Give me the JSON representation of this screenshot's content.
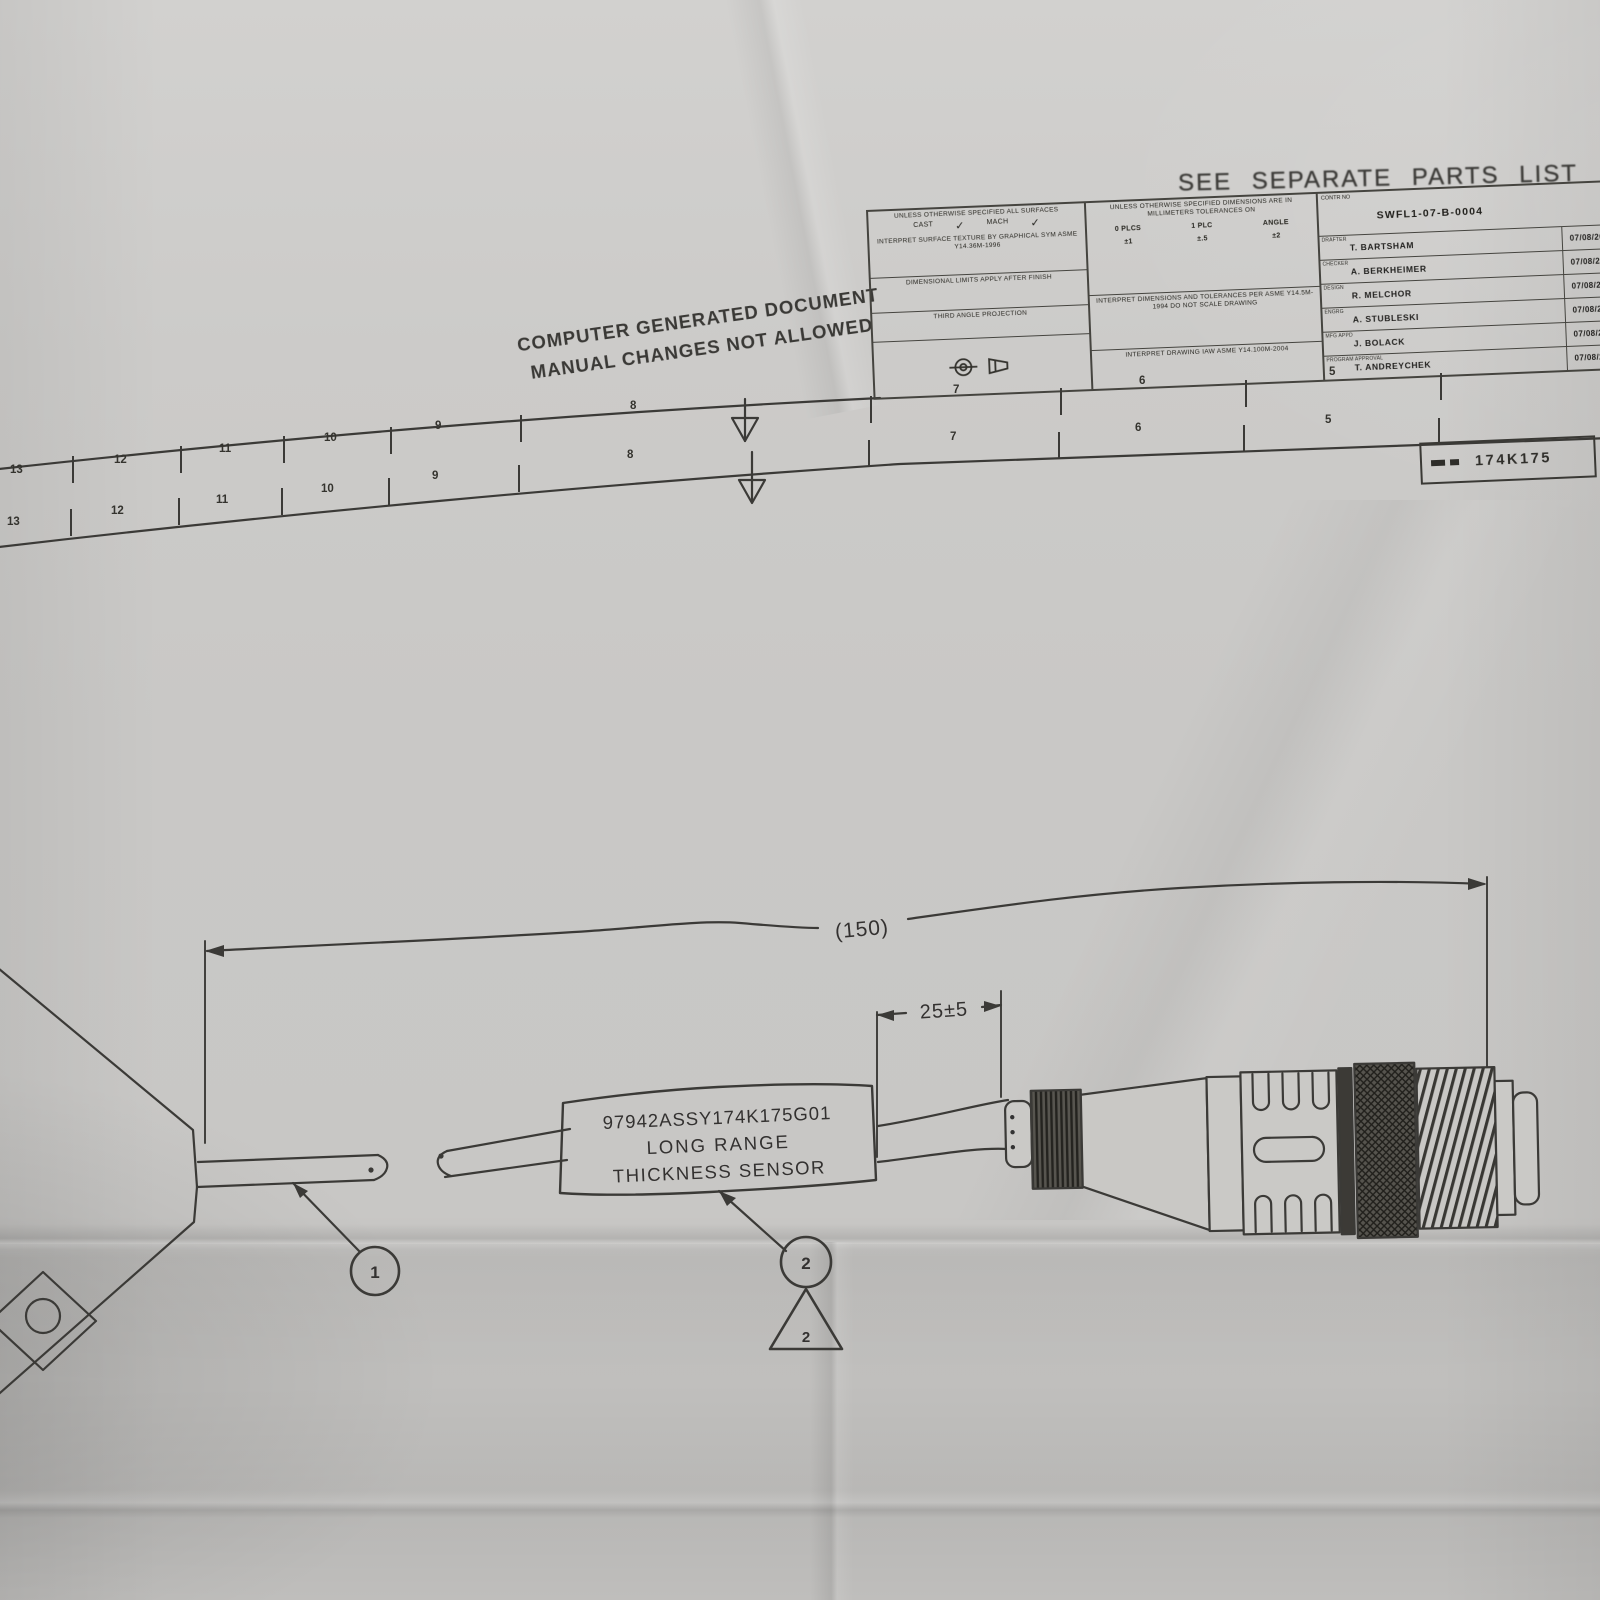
{
  "header": {
    "parts_note": "SEE  SEPARATE  PARTS  LIST"
  },
  "doc_note": {
    "line1": "COMPUTER GENERATED DOCUMENT",
    "line2": "MANUAL CHANGES NOT ALLOWED"
  },
  "title_block": {
    "surface_note": "UNLESS OTHERWISE SPECIFIED ALL SURFACES",
    "cast_label": "CAST",
    "mach_label": "MACH",
    "check_glyph": "✓",
    "texture_note": "INTERPRET SURFACE TEXTURE BY GRAPHICAL SYM ASME Y14.36M-1996",
    "limits_note": "DIMENSIONAL LIMITS APPLY AFTER FINISH",
    "projection_note": "THIRD ANGLE PROJECTION",
    "tolerance_header": "UNLESS OTHERWISE SPECIFIED DIMENSIONS ARE IN MILLIMETERS TOLERANCES ON",
    "tolerance_cols": [
      "0 PLCS",
      "1 PLC",
      "ANGLE"
    ],
    "tolerance_vals": [
      "±1",
      "±.5",
      "±2"
    ],
    "dims_note": "INTERPRET DIMENSIONS AND TOLERANCES PER ASME Y14.5M-1994 DO NOT SCALE DRAWING",
    "drawing_note": "INTERPRET DRAWING IAW ASME Y14.100M-2004",
    "contract_label": "CONTR NO",
    "contract_no": "SWFL1-07-B-0004",
    "approvals": [
      {
        "role": "DRAFTER",
        "name": "T. BARTSHAM",
        "date": "07/08/20"
      },
      {
        "role": "CHECKER",
        "name": "A. BERKHEIMER",
        "date": "07/08/20"
      },
      {
        "role": "DESIGN",
        "name": "R. MELCHOR",
        "date": "07/08/20"
      },
      {
        "role": "ENGRG",
        "name": "A. STUBLESKI",
        "date": "07/08/20"
      },
      {
        "role": "MFG APPD",
        "name": "J. BOLACK",
        "date": "07/08/20"
      },
      {
        "role": "PROGRAM APPROVAL",
        "name": "T. ANDREYCHEK",
        "date": "07/08/20"
      }
    ],
    "size_code": "A1",
    "partial_letter": "L"
  },
  "border": {
    "drawing_number": "174K175",
    "zones_upper": [
      {
        "label": "13",
        "x": 16,
        "y": 471
      },
      {
        "label": "12",
        "x": 120,
        "y": 461
      },
      {
        "label": "11",
        "x": 225,
        "y": 450
      },
      {
        "label": "10",
        "x": 330,
        "y": 439
      },
      {
        "label": "9",
        "x": 441,
        "y": 427
      },
      {
        "label": "8",
        "x": 636,
        "y": 407
      },
      {
        "label": "7",
        "x": 959,
        "y": 391
      },
      {
        "label": "6",
        "x": 1145,
        "y": 382
      },
      {
        "label": "5",
        "x": 1335,
        "y": 373
      }
    ],
    "ticks_upper": [
      {
        "x": 72,
        "y": 456
      },
      {
        "x": 180,
        "y": 446
      },
      {
        "x": 283,
        "y": 436
      },
      {
        "x": 390,
        "y": 427
      },
      {
        "x": 520,
        "y": 415
      },
      {
        "x": 870,
        "y": 396
      },
      {
        "x": 1060,
        "y": 388
      },
      {
        "x": 1245,
        "y": 380
      },
      {
        "x": 1440,
        "y": 373
      }
    ],
    "zones_lower": [
      {
        "label": "13",
        "x": 13,
        "y": 523
      },
      {
        "label": "12",
        "x": 117,
        "y": 512
      },
      {
        "label": "11",
        "x": 222,
        "y": 501
      },
      {
        "label": "10",
        "x": 327,
        "y": 490
      },
      {
        "label": "9",
        "x": 438,
        "y": 477
      },
      {
        "label": "8",
        "x": 633,
        "y": 456
      },
      {
        "label": "7",
        "x": 956,
        "y": 438
      },
      {
        "label": "6",
        "x": 1141,
        "y": 429
      },
      {
        "label": "5",
        "x": 1331,
        "y": 421
      }
    ],
    "ticks_lower": [
      {
        "x": 70,
        "y": 536
      },
      {
        "x": 178,
        "y": 525
      },
      {
        "x": 281,
        "y": 515
      },
      {
        "x": 388,
        "y": 505
      },
      {
        "x": 518,
        "y": 492
      },
      {
        "x": 868,
        "y": 467
      },
      {
        "x": 1058,
        "y": 459
      },
      {
        "x": 1243,
        "y": 452
      },
      {
        "x": 1438,
        "y": 445
      }
    ]
  },
  "diagram": {
    "overall_dim": "(150)",
    "connector_dim": "25±5",
    "label_box": [
      "97942ASSY174K175G01",
      "LONG RANGE",
      "THICKNESS SENSOR"
    ],
    "balloon_1": "1",
    "balloon_2": "2",
    "revision_flag": "2"
  }
}
